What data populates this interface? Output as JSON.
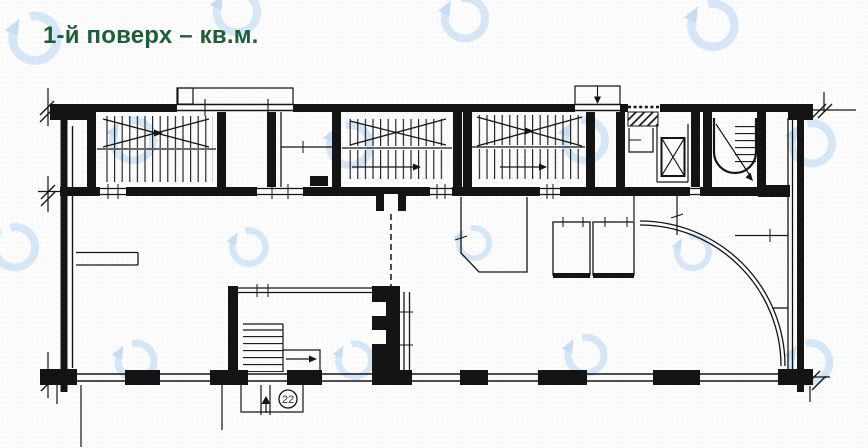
{
  "page": {
    "background": "#FCFCFC"
  },
  "header": {
    "title": "1-й поверх – кв.м.",
    "title_color": "#1C5E38"
  },
  "plan": {
    "badge_22": "22",
    "ink_color": "#141414"
  },
  "watermark": {
    "icon": "circular-arrow-logo-icon",
    "ring_color": "#CBE0F4",
    "arrow_color": "#BAD6EF"
  }
}
